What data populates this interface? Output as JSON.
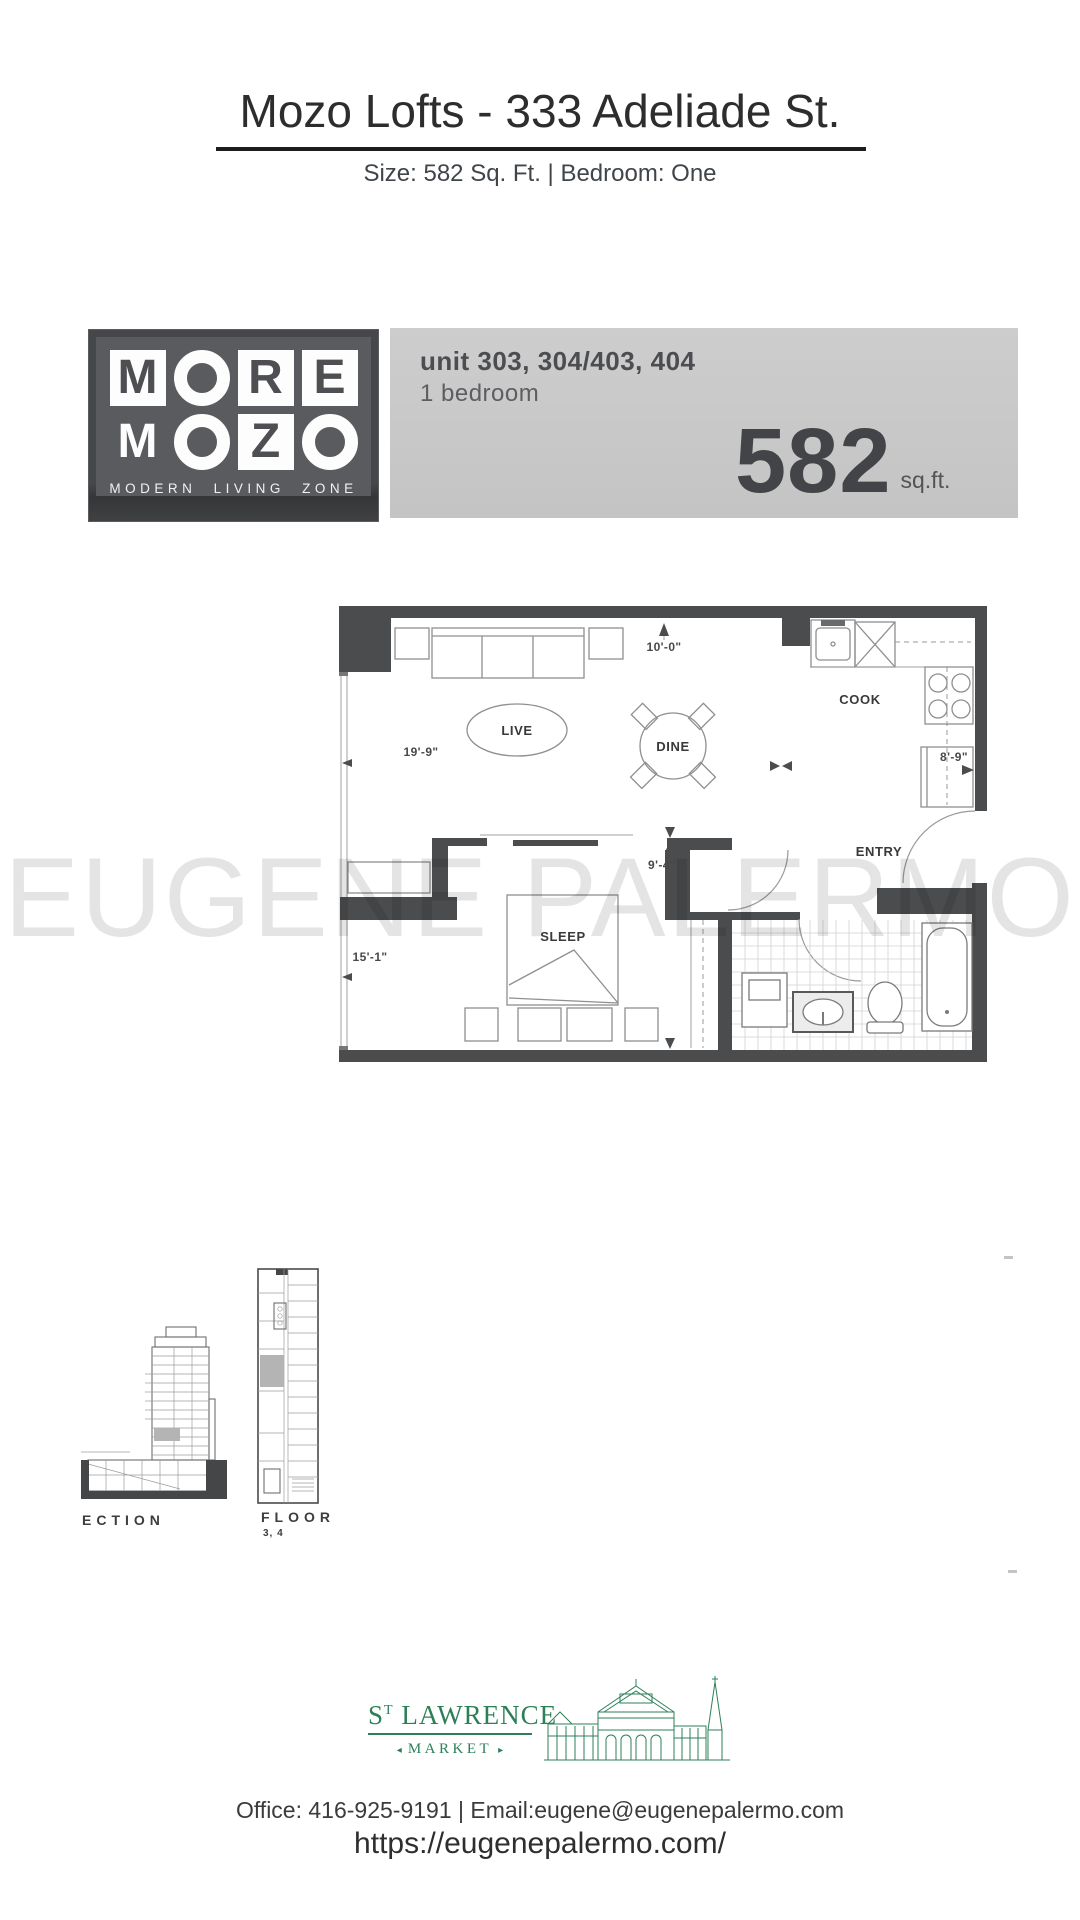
{
  "header": {
    "title": "Mozo Lofts - 333 Adeliade St.",
    "subtitle": "Size: 582 Sq. Ft. |  Bedroom: One"
  },
  "brand": {
    "row1": [
      "M",
      "O",
      "R",
      "E"
    ],
    "row2": [
      "M",
      "O",
      "Z",
      "O"
    ],
    "tagline": "MODERN LIVING ZONE"
  },
  "banner": {
    "unit_line": "unit 303, 304/403, 404",
    "bedroom_line": "1 bedroom",
    "area_value": "582",
    "area_unit": "sq.ft."
  },
  "floorplan": {
    "labels": {
      "live": "LIVE",
      "dine": "DINE",
      "cook": "COOK",
      "entry": "ENTRY",
      "sleep": "SLEEP"
    },
    "dims": {
      "top": "10'-0\"",
      "living": "19'-9\"",
      "kitchen": "8'-9\"",
      "bedroom_width": "9'-4\"",
      "bedroom_length": "15'-1\""
    }
  },
  "watermark": "EUGENE PALERMO",
  "diagrams": {
    "section_label": "ECTION",
    "floor_label": "FLOOR",
    "floor_sublabel": "3, 4"
  },
  "market_logo": {
    "name_s": "S",
    "name_t": "T",
    "name_rest": " LAWRENCE",
    "arrow_left": "◂",
    "market": "MARKET",
    "arrow_right": "▸"
  },
  "footer": {
    "contact": "Office: 416-925-9191  |  Email:eugene@eugenepalermo.com",
    "website": "https://eugenepalermo.com/"
  }
}
